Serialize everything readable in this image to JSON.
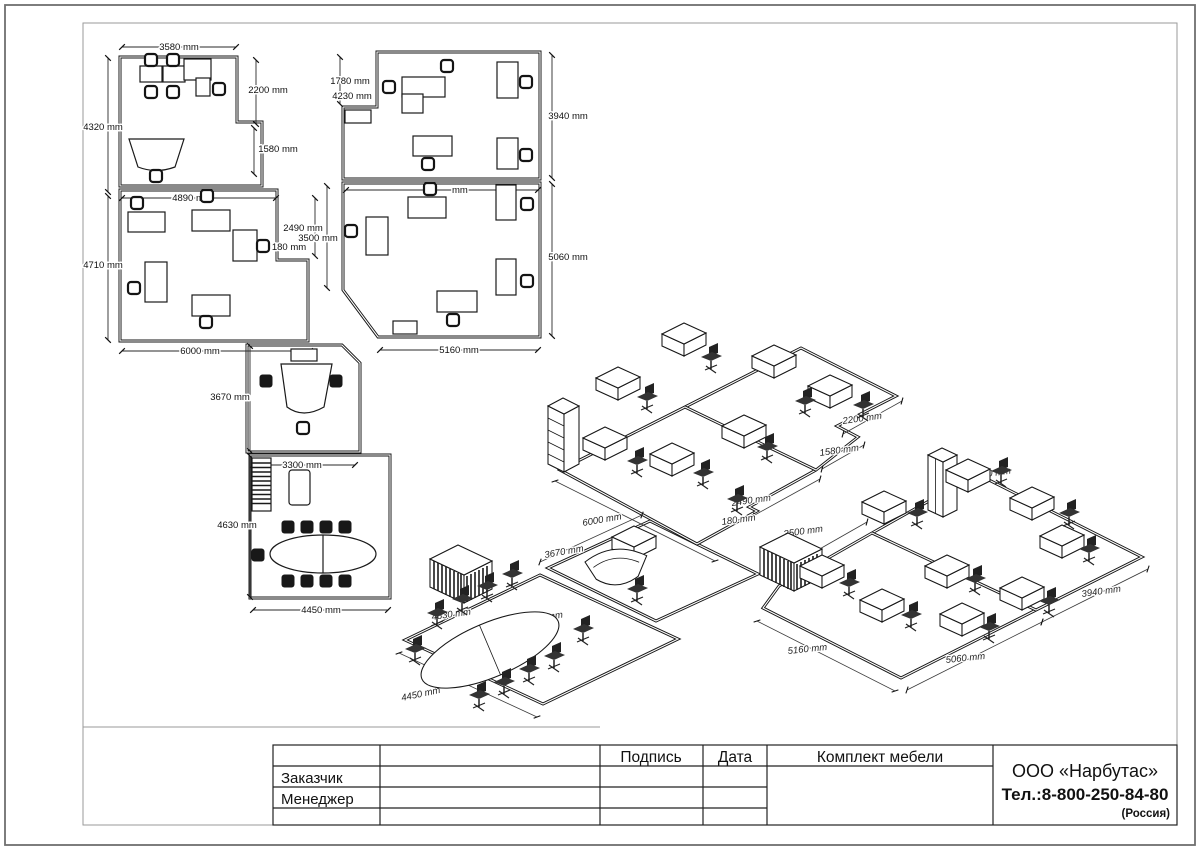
{
  "plan": {
    "dims": {
      "a_top": "3580 mm",
      "a_right": "2200 mm",
      "a_left": "4320 mm",
      "a_step": "1580 mm",
      "b_top": "4890 mm",
      "b_left": "4710 mm",
      "b_bottom": "6000 mm",
      "b_step_depth": "2490 mm",
      "b_step_width": "180 mm",
      "c_left": "3670 mm",
      "d_top": "3300 mm",
      "d_left": "4630 mm",
      "d_bottom": "4450 mm",
      "e_notch_h": "1780 mm",
      "e_notch_w": "4230 mm",
      "e_right": "3940 mm",
      "f_top_partial": "mm",
      "f_left": "3500 mm",
      "f_right": "5060 mm",
      "f_bottom": "5160 mm"
    }
  },
  "iso": {
    "dims": {
      "room_b_bottom": "6000 mm",
      "room_a_right": "2200 mm",
      "room_a_step": "1580 mm",
      "room_b_step_depth": "2490 mm",
      "room_b_step_width": "180 mm",
      "meeting_bottom": "4450 mm",
      "meeting_left": "4630 mm",
      "meeting_inner": "3300 mm",
      "reception_left": "3670 mm",
      "room_f_left": "3500 mm",
      "room_f_bottom": "5160 mm",
      "room_f_right": "5060 mm",
      "room_e_right": "3940 mm",
      "room_e_notch_w": "4230 mm",
      "room_e_notch_h": "1780 mm"
    }
  },
  "title_block": {
    "signature_label": "Подпись",
    "date_label": "Дата",
    "project_label": "Комплект мебели",
    "customer_label": "Заказчик",
    "manager_label": "Менеджер",
    "company_name": "ООО «Нарбутас»",
    "company_phone": "Тел.:8-800-250-84-80",
    "company_country": "(Россия)"
  },
  "colors": {
    "ink": "#161616",
    "sheet_border": "#6f6f6f",
    "viewport_frame": "#9a9a9a"
  }
}
